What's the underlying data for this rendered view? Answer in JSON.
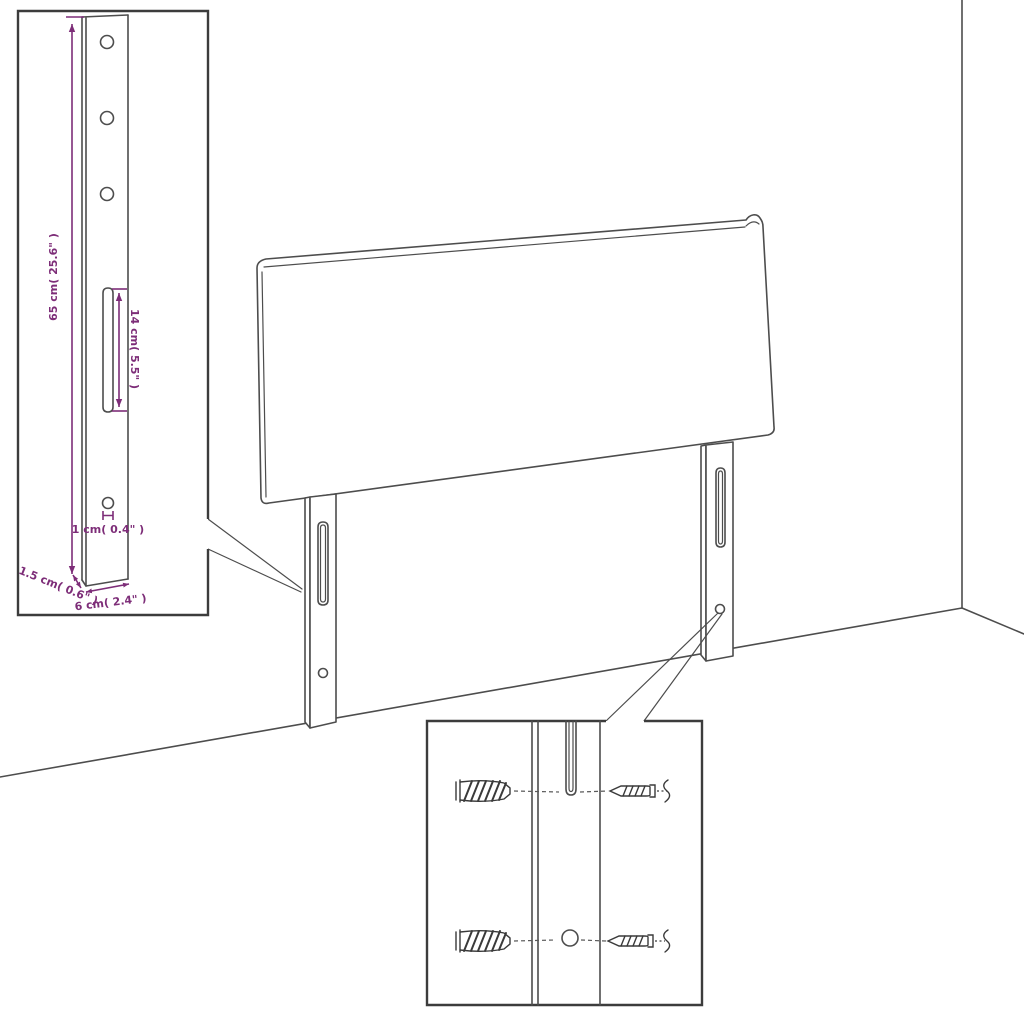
{
  "colors": {
    "line": "#4d4d4d",
    "dimension": "#7d2d78",
    "inset_border": "#3c3c3c",
    "background": "#ffffff"
  },
  "leg_inset": {
    "labels": {
      "height": "65 cm( 25.6\" )",
      "slot": "14 cm( 5.5\" )",
      "hole": "1 cm( 0.4\" )",
      "thickness": "1.5 cm( 0.6\" )",
      "width": "6 cm( 2.4\" )"
    }
  },
  "hardware_inset": {
    "icons": [
      {
        "name": "wall-plug-icon",
        "row": "top"
      },
      {
        "name": "screw-icon",
        "row": "top"
      },
      {
        "name": "wall-plug-icon",
        "row": "bottom"
      },
      {
        "name": "screw-icon",
        "row": "bottom"
      }
    ]
  }
}
